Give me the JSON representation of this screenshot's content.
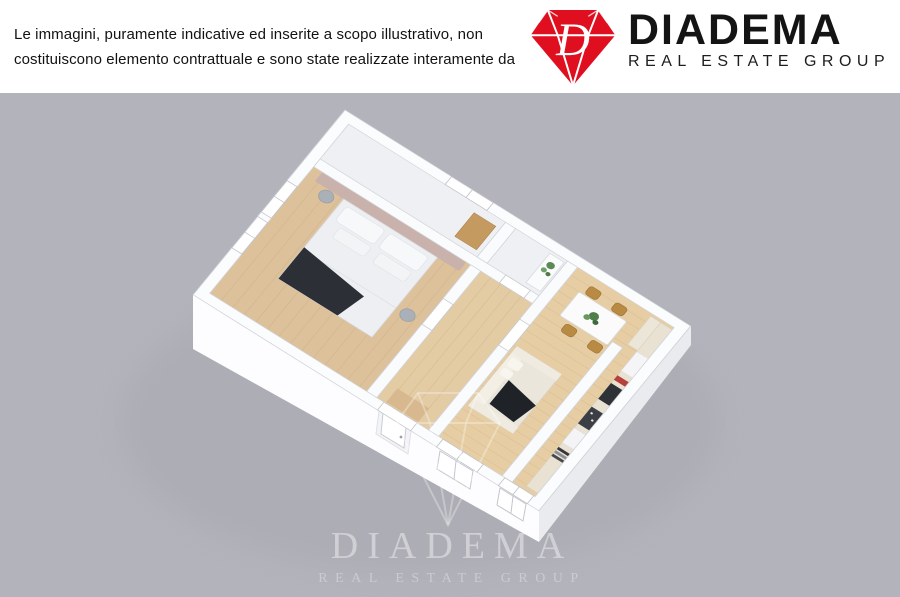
{
  "header": {
    "disclaimer_line1": "Le immagini, puramente indicative ed inserite a scopo illustrativo, non",
    "disclaimer_line2": "costituiscono elemento contrattuale e sono state realizzate interamente da",
    "logo": {
      "monogram": "D",
      "brand": "DIADEMA",
      "tagline": "REAL ESTATE GROUP",
      "diamond_color": "#df0f1f",
      "text_color": "#141414"
    }
  },
  "floorplan": {
    "type": "3d-floor-plan-render",
    "background_color": "#b3b3bb",
    "wall_color": "#fbfcfe",
    "wood_floor_color": "#e2c89e",
    "rooms_depicted": [
      "bedroom",
      "hallway",
      "bathroom",
      "closet-room",
      "living-dining-room",
      "kitchen"
    ],
    "furniture_depicted": [
      "double-bed",
      "nightstands",
      "sofa",
      "dining-table",
      "chairs",
      "kitchen-counter",
      "appliances",
      "plant"
    ],
    "watermark": {
      "brand": "DIADEMA",
      "tagline": "REAL ESTATE GROUP"
    }
  }
}
